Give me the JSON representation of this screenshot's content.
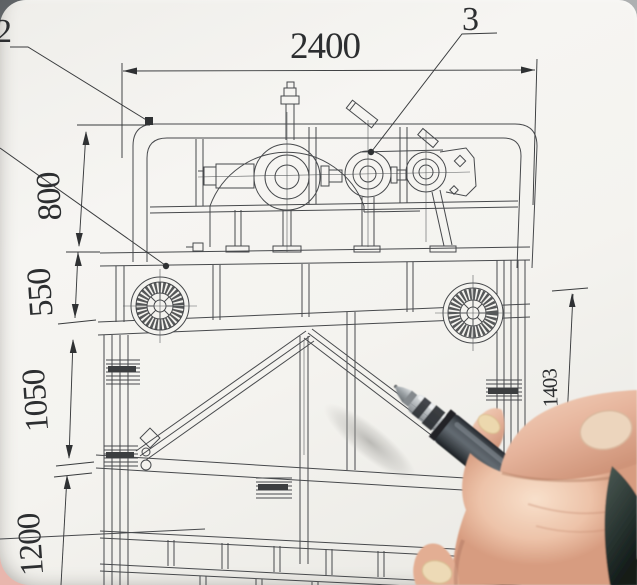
{
  "drawing": {
    "dims": {
      "top_width": "2400",
      "upper_height": "800",
      "mid_height": "550",
      "lower_height": "1050",
      "bottom_height": "1200",
      "right_height": "1403"
    },
    "callouts": {
      "left": "2",
      "right": "3"
    },
    "line_color": "#47494c",
    "paper_color": "#f4f3ef"
  },
  "scene": {
    "pen_color": "#4e555b",
    "skin_color": "#e6b49f",
    "background_gray": "#8e9193"
  }
}
